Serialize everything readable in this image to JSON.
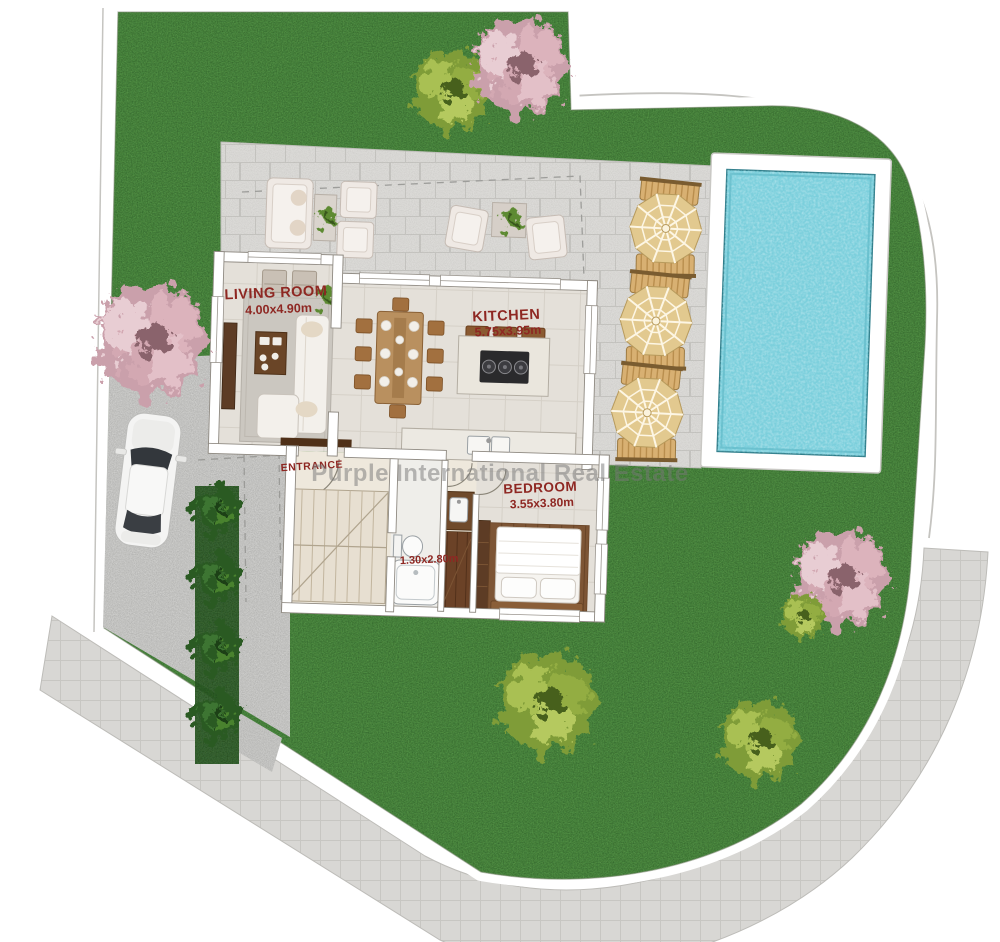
{
  "plan": {
    "title": "Villa ground-floor site plan",
    "watermark": "Purple International Real Estate"
  },
  "rooms": {
    "living": {
      "name": "LIVING ROOM",
      "dims": "4.00x4.90m"
    },
    "kitchen": {
      "name": "KITCHEN",
      "dims": "5.75x3.95m"
    },
    "entrance": {
      "name": "ENTRANCE"
    },
    "bedroom": {
      "name": "BEDROOM",
      "dims": "3.55x3.80m"
    },
    "bathroom": {
      "dims": "1.30x2.80m"
    }
  },
  "features": {
    "pool": "swimming-pool",
    "terrace": "paved-terrace",
    "driveway": "driveway",
    "sidewalk": "sidewalk",
    "lawn": "lawn",
    "car": "white-car",
    "umbrella_sets": 3,
    "sun_loungers": 6,
    "hedge_bushes": 4,
    "blossom_trees": 3,
    "green_trees": 3
  },
  "colors": {
    "lawn": "#4e8c42",
    "lawn_dark": "#2c5c26",
    "terrace": "#dcdbd8",
    "driveway": "#c9c9c7",
    "sidewalk": "#d8d7d4",
    "pool_water": "#7bcfdc",
    "pool_deck": "#ffffff",
    "floor": "#e4e0d9",
    "wood": "#6b4227",
    "label": "#8e2722",
    "watermark": "#787878",
    "umbrella": "#e2c98f",
    "hedge": "#2c5c26",
    "blossom": "#d9aab4"
  }
}
